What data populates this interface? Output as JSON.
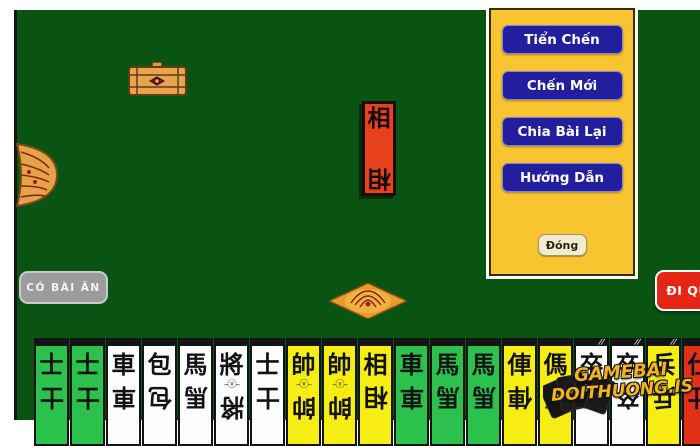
{
  "menu": {
    "buttons": [
      "Tiển Chến",
      "Chến Mới",
      "Chia Bài Lại",
      "Hướng Dẫn"
    ],
    "close_label": "Đóng"
  },
  "actions": {
    "eat_button": "CÓ BÀI ĂN",
    "pass_button": "ĐI QUA"
  },
  "center_tile": {
    "char": "相"
  },
  "watermark": {
    "line1": "GAMEBAI",
    "line2": "DOITHUONG.IS"
  },
  "icons": [
    "treasure-chest-icon",
    "flower-decoration",
    "diamond-decoration",
    "cards-logo-icon"
  ],
  "colors": {
    "felt_green": "#095413",
    "panel_yellow": "#f8c530",
    "menu_button_blue": "#221e9e",
    "tile_red": "#e8411d",
    "card_green": "#2cc04c",
    "card_yellow": "#f6ee12",
    "card_white": "#fdfdfd",
    "card_red": "#e2311a",
    "eat_button_gray": "#9c9c9c",
    "pass_button_red": "#e52615",
    "watermark_gold": "#f6b41c"
  },
  "card_top_marks_glyph": "//",
  "emblem_glyph": "–ⓥ–",
  "cards": [
    {
      "char": "士",
      "color": "green",
      "emblem": false,
      "marks": false
    },
    {
      "char": "士",
      "color": "green",
      "emblem": false,
      "marks": false
    },
    {
      "char": "車",
      "color": "white",
      "emblem": false,
      "marks": false
    },
    {
      "char": "包",
      "color": "white",
      "emblem": false,
      "marks": false
    },
    {
      "char": "馬",
      "color": "white",
      "emblem": false,
      "marks": false
    },
    {
      "char": "將",
      "color": "white",
      "emblem": true,
      "marks": false
    },
    {
      "char": "士",
      "color": "white",
      "emblem": false,
      "marks": false
    },
    {
      "char": "帥",
      "color": "yellow",
      "emblem": true,
      "marks": false
    },
    {
      "char": "帥",
      "color": "yellow",
      "emblem": true,
      "marks": false
    },
    {
      "char": "相",
      "color": "yellow",
      "emblem": false,
      "marks": false
    },
    {
      "char": "車",
      "color": "green",
      "emblem": false,
      "marks": false
    },
    {
      "char": "馬",
      "color": "green",
      "emblem": false,
      "marks": false
    },
    {
      "char": "馬",
      "color": "green",
      "emblem": false,
      "marks": false
    },
    {
      "char": "俥",
      "color": "yellow",
      "emblem": false,
      "marks": false
    },
    {
      "char": "傌",
      "color": "yellow",
      "emblem": false,
      "marks": false
    },
    {
      "char": "卒",
      "color": "white",
      "emblem": false,
      "marks": true
    },
    {
      "char": "卒",
      "color": "white",
      "emblem": false,
      "marks": true
    },
    {
      "char": "兵",
      "color": "yellow",
      "emblem": false,
      "marks": true
    },
    {
      "char": "仕",
      "color": "red",
      "emblem": false,
      "marks": false
    },
    {
      "char": "俥",
      "color": "red",
      "emblem": false,
      "marks": false
    }
  ]
}
